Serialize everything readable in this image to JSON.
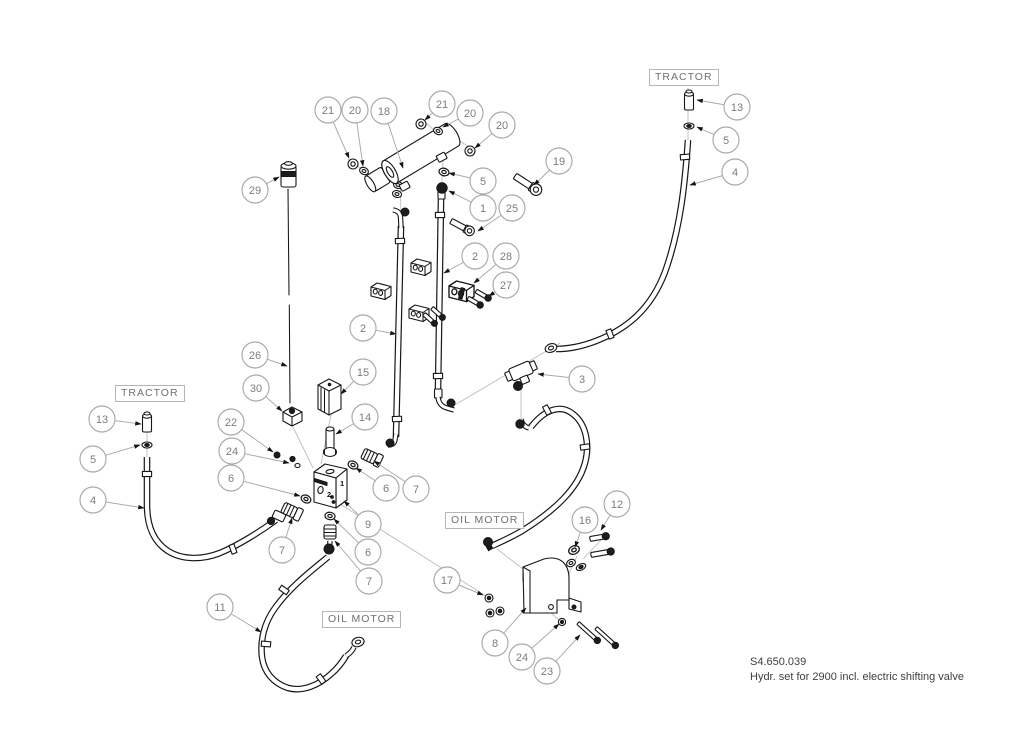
{
  "caption": {
    "code": "S4.650.039",
    "description": "Hydr. set for 2900 incl. electric shifting valve"
  },
  "labels": [
    {
      "id": "tractor-right",
      "text": "TRACTOR",
      "x": 649,
      "y": 69
    },
    {
      "id": "tractor-left",
      "text": "TRACTOR",
      "x": 115,
      "y": 385
    },
    {
      "id": "oil-motor-left",
      "text": "OIL MOTOR",
      "x": 322,
      "y": 611
    },
    {
      "id": "oil-motor-right",
      "text": "OIL MOTOR",
      "x": 445,
      "y": 512
    }
  ],
  "block_marks": [
    {
      "t": "1",
      "x": 340,
      "y": 486
    },
    {
      "t": "2",
      "x": 327,
      "y": 497
    }
  ],
  "callouts": [
    {
      "n": "21",
      "cx": 328,
      "cy": 110,
      "tx": 349,
      "ty": 158
    },
    {
      "n": "20",
      "cx": 355,
      "cy": 110,
      "tx": 363,
      "ty": 166
    },
    {
      "n": "18",
      "cx": 384,
      "cy": 111,
      "tx": 403,
      "ty": 168
    },
    {
      "n": "21",
      "cx": 442,
      "cy": 104,
      "tx": 425,
      "ty": 120
    },
    {
      "n": "20",
      "cx": 470,
      "cy": 113,
      "tx": 443,
      "ty": 127
    },
    {
      "n": "20",
      "cx": 502,
      "cy": 125,
      "tx": 475,
      "ty": 148
    },
    {
      "n": "19",
      "cx": 559,
      "cy": 161,
      "tx": 534,
      "ty": 185
    },
    {
      "n": "5",
      "cx": 483,
      "cy": 181,
      "tx": 449,
      "ty": 173
    },
    {
      "n": "1",
      "cx": 483,
      "cy": 208,
      "tx": 449,
      "ty": 191
    },
    {
      "n": "25",
      "cx": 512,
      "cy": 208,
      "tx": 478,
      "ty": 231
    },
    {
      "n": "13",
      "cx": 737,
      "cy": 107,
      "tx": 697,
      "ty": 100
    },
    {
      "n": "5",
      "cx": 726,
      "cy": 140,
      "tx": 697,
      "ty": 127
    },
    {
      "n": "4",
      "cx": 735,
      "cy": 172,
      "tx": 690,
      "ty": 185
    },
    {
      "n": "2",
      "cx": 475,
      "cy": 256,
      "tx": 444,
      "ty": 273
    },
    {
      "n": "28",
      "cx": 506,
      "cy": 256,
      "tx": 474,
      "ty": 283
    },
    {
      "n": "27",
      "cx": 506,
      "cy": 285,
      "tx": 489,
      "ty": 296
    },
    {
      "n": "2",
      "cx": 363,
      "cy": 328,
      "tx": 396,
      "ty": 334
    },
    {
      "n": "29",
      "cx": 255,
      "cy": 190,
      "tx": 279,
      "ty": 177
    },
    {
      "n": "26",
      "cx": 255,
      "cy": 355,
      "tx": 287,
      "ty": 366
    },
    {
      "n": "30",
      "cx": 256,
      "cy": 388,
      "tx": 282,
      "ty": 411
    },
    {
      "n": "15",
      "cx": 363,
      "cy": 372,
      "tx": 341,
      "ty": 394
    },
    {
      "n": "14",
      "cx": 365,
      "cy": 417,
      "tx": 336,
      "ty": 434
    },
    {
      "n": "3",
      "cx": 582,
      "cy": 379,
      "tx": 538,
      "ty": 374
    },
    {
      "n": "13",
      "cx": 102,
      "cy": 419,
      "tx": 141,
      "ty": 424
    },
    {
      "n": "5",
      "cx": 93,
      "cy": 459,
      "tx": 140,
      "ty": 445
    },
    {
      "n": "4",
      "cx": 93,
      "cy": 500,
      "tx": 144,
      "ty": 508
    },
    {
      "n": "22",
      "cx": 231,
      "cy": 422,
      "tx": 273,
      "ty": 452
    },
    {
      "n": "24",
      "cx": 232,
      "cy": 451,
      "tx": 289,
      "ty": 463
    },
    {
      "n": "6",
      "cx": 231,
      "cy": 478,
      "tx": 300,
      "ty": 496
    },
    {
      "n": "7",
      "cx": 282,
      "cy": 550,
      "tx": 292,
      "ty": 518
    },
    {
      "n": "6",
      "cx": 386,
      "cy": 488,
      "tx": 356,
      "ty": 468
    },
    {
      "n": "7",
      "cx": 416,
      "cy": 489,
      "tx": 374,
      "ty": 461
    },
    {
      "n": "9",
      "cx": 368,
      "cy": 524,
      "tx": 344,
      "ty": 501
    },
    {
      "n": "6",
      "cx": 368,
      "cy": 552,
      "tx": 334,
      "ty": 519
    },
    {
      "n": "7",
      "cx": 369,
      "cy": 581,
      "tx": 335,
      "ty": 541
    },
    {
      "n": "11",
      "cx": 220,
      "cy": 607,
      "tx": 261,
      "ty": 632
    },
    {
      "n": "17",
      "cx": 447,
      "cy": 580,
      "tx": 483,
      "ty": 595
    },
    {
      "n": "8",
      "cx": 495,
      "cy": 643,
      "tx": 526,
      "ty": 608
    },
    {
      "n": "24",
      "cx": 522,
      "cy": 657,
      "tx": 559,
      "ty": 624
    },
    {
      "n": "23",
      "cx": 547,
      "cy": 671,
      "tx": 580,
      "ty": 635
    },
    {
      "n": "16",
      "cx": 585,
      "cy": 520,
      "tx": 575,
      "ty": 547
    },
    {
      "n": "12",
      "cx": 617,
      "cy": 504,
      "tx": 601,
      "ty": 530
    }
  ],
  "colors": {
    "line": "#161616",
    "leader": "#a9a9a9",
    "callout_text": "#7c7c7c",
    "label_text": "#707070",
    "caption_text": "#3f3f3f"
  }
}
